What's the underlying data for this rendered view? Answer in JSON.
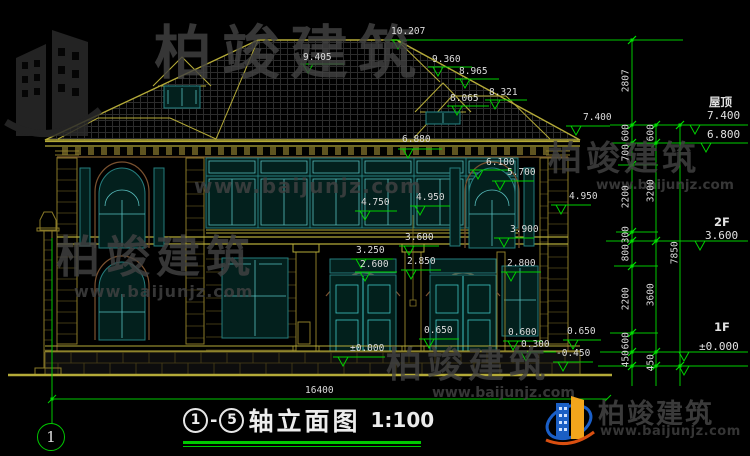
{
  "watermark": {
    "brand": "柏竣建筑",
    "url": "www.baijunjz.com"
  },
  "logo": {
    "brand": "柏竣建筑",
    "url": "www.baijunjz.com"
  },
  "title_block": {
    "axis_from": "1",
    "dash": "-",
    "axis_to": "5",
    "title": "轴立面图",
    "scale": "1:100"
  },
  "axis_bubbles": {
    "bottom_left": "1"
  },
  "levels": {
    "roof_label": "屋顶",
    "roof_value": "7.400",
    "eave_value": "6.800",
    "f2_label": "2F",
    "f2_value": "3.600",
    "f1_label": "1F",
    "f1_value": "±0.000"
  },
  "dims": {
    "k10207": "10.207",
    "k9405": "9.405",
    "k9360": "9.360",
    "k8965": "8.965",
    "k8321": "8.321",
    "k8065": "8.065",
    "k7400": "7.400",
    "k6880": "6.880",
    "k6100": "6.100",
    "k5700": "5.700",
    "k4950c": "4.950",
    "k4750": "4.750",
    "k4950r": "4.950",
    "k3900": "3.900",
    "k3600": "3.600",
    "k3250": "3.250",
    "k2850": "2.850",
    "k2600": "2.600",
    "k2800": "2.800",
    "k0650l": "0.650",
    "k0600": "0.600",
    "k0300": "0.300",
    "k0650r": "0.650",
    "kzero": "±0.000",
    "km0450": "-0.450"
  },
  "chains": {
    "inner": [
      "2807",
      "600",
      "700",
      "2200",
      "300",
      "800",
      "2200",
      "600",
      "450"
    ],
    "middle": [
      "600",
      "3200",
      "3600",
      "450"
    ],
    "overall_height": "7850",
    "overall_width": "16400"
  },
  "colors": {
    "dim_green": "#00c800",
    "cad_yellow": "#b4aa38",
    "window_teal": "#257d7d",
    "watermark_gray": "#404040"
  }
}
